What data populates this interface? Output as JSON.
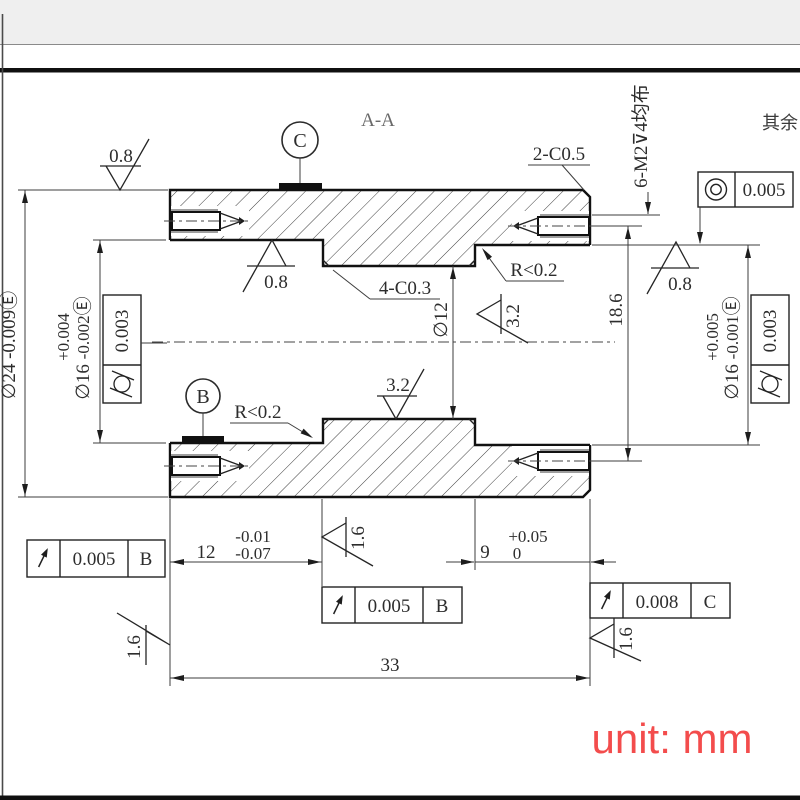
{
  "header": {
    "section_label": "A-A",
    "others_note": "其余"
  },
  "notes": {
    "thread": "6-M2⊽4均布",
    "chamfer_outer": "2-C0.5",
    "chamfer_inner": "4-C0.3",
    "radius_left": "R<0.2",
    "radius_right": "R<0.2"
  },
  "datums": {
    "b": "B",
    "c": "C"
  },
  "dims": {
    "dia24": {
      "prefix": "∅24 ",
      "tol": "-0.009",
      "env": "Ⓔ"
    },
    "dia16L": {
      "prefix": "∅16 ",
      "tol_up": "+0.004",
      "tol_dn": "-0.002",
      "env": "Ⓔ"
    },
    "dia16R": {
      "prefix": "∅16 ",
      "tol_up": "+0.005",
      "tol_dn": "-0.001",
      "env": "Ⓔ"
    },
    "dia12": "∅12",
    "h186": "18.6",
    "len12": {
      "v": "12",
      "up": "-0.01",
      "dn": "-0.07"
    },
    "len9": {
      "v": "9",
      "up": "+0.05",
      "dn": "0"
    },
    "len33": "33"
  },
  "roughness": {
    "top": "0.8",
    "boreL": "0.8",
    "right": "0.8",
    "boreC": "3.2",
    "boreR": "3.2",
    "stepC": "1.6",
    "faceL": "1.6",
    "faceR": "1.6"
  },
  "gdt": {
    "conc": {
      "icon": "concentricity",
      "value": "0.005"
    },
    "cylL": {
      "icon": "cylindricity",
      "value": "0.003"
    },
    "cylR": {
      "icon": "cylindricity",
      "value": "0.003"
    },
    "runL": {
      "icon": "circular-runout",
      "value": "0.005",
      "datum": "B"
    },
    "runC": {
      "icon": "circular-runout",
      "value": "0.005",
      "datum": "B"
    },
    "runR": {
      "icon": "circular-runout",
      "value": "0.008",
      "datum": "C"
    }
  },
  "footer": {
    "unit_note": "unit: mm"
  },
  "colors": {
    "ink": "#1b1b1b",
    "accent_red": "#f34c4c",
    "band_gray": "#efefef"
  }
}
